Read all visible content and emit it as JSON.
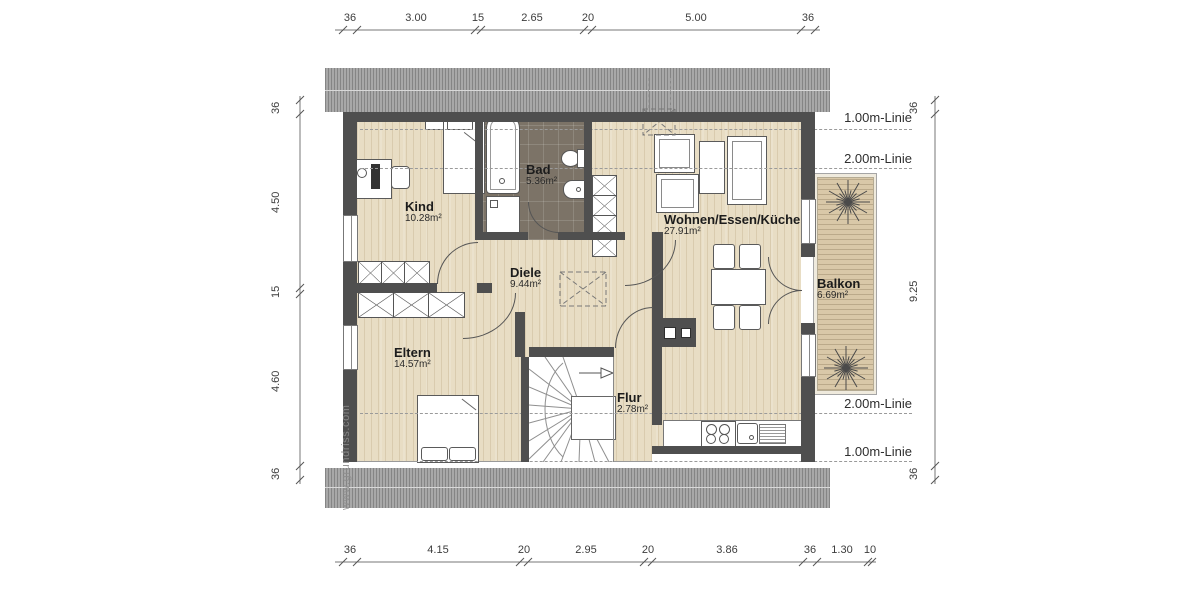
{
  "watermark": "www.grundriss.com",
  "rooms": {
    "kind": {
      "name": "Kind",
      "area": "10.28m²"
    },
    "bad": {
      "name": "Bad",
      "area": "5.36m²"
    },
    "wohnen": {
      "name": "Wohnen/Essen/Küche",
      "area": "27.91m²"
    },
    "diele": {
      "name": "Diele",
      "area": "9.44m²"
    },
    "eltern": {
      "name": "Eltern",
      "area": "14.57m²"
    },
    "flur": {
      "name": "Flur",
      "area": "2.78m²"
    },
    "balkon": {
      "name": "Balkon",
      "area": "6.69m²"
    }
  },
  "height_lines": {
    "north_1m": "1.00m-Linie",
    "north_2m": "2.00m-Linie",
    "south_2m": "2.00m-Linie",
    "south_1m": "1.00m-Linie"
  },
  "dimensions": {
    "top": [
      "36",
      "3.00",
      "15",
      "2.65",
      "20",
      "5.00",
      "36"
    ],
    "bottom": [
      "36",
      "4.15",
      "20",
      "2.95",
      "20",
      "3.86",
      "36",
      "1.30",
      "10"
    ],
    "left": [
      "36",
      "4.50",
      "15",
      "4.60",
      "36"
    ],
    "right": [
      "36",
      "9.25",
      "36"
    ]
  },
  "colors": {
    "wall": "#4f4f4f",
    "wood_floor": "#e8ddc4",
    "tile_floor": "#7c7367",
    "deck": "#d9c8a8",
    "roof_hatch": "#9e9e9e",
    "dash_line": "#9a9a9a"
  }
}
